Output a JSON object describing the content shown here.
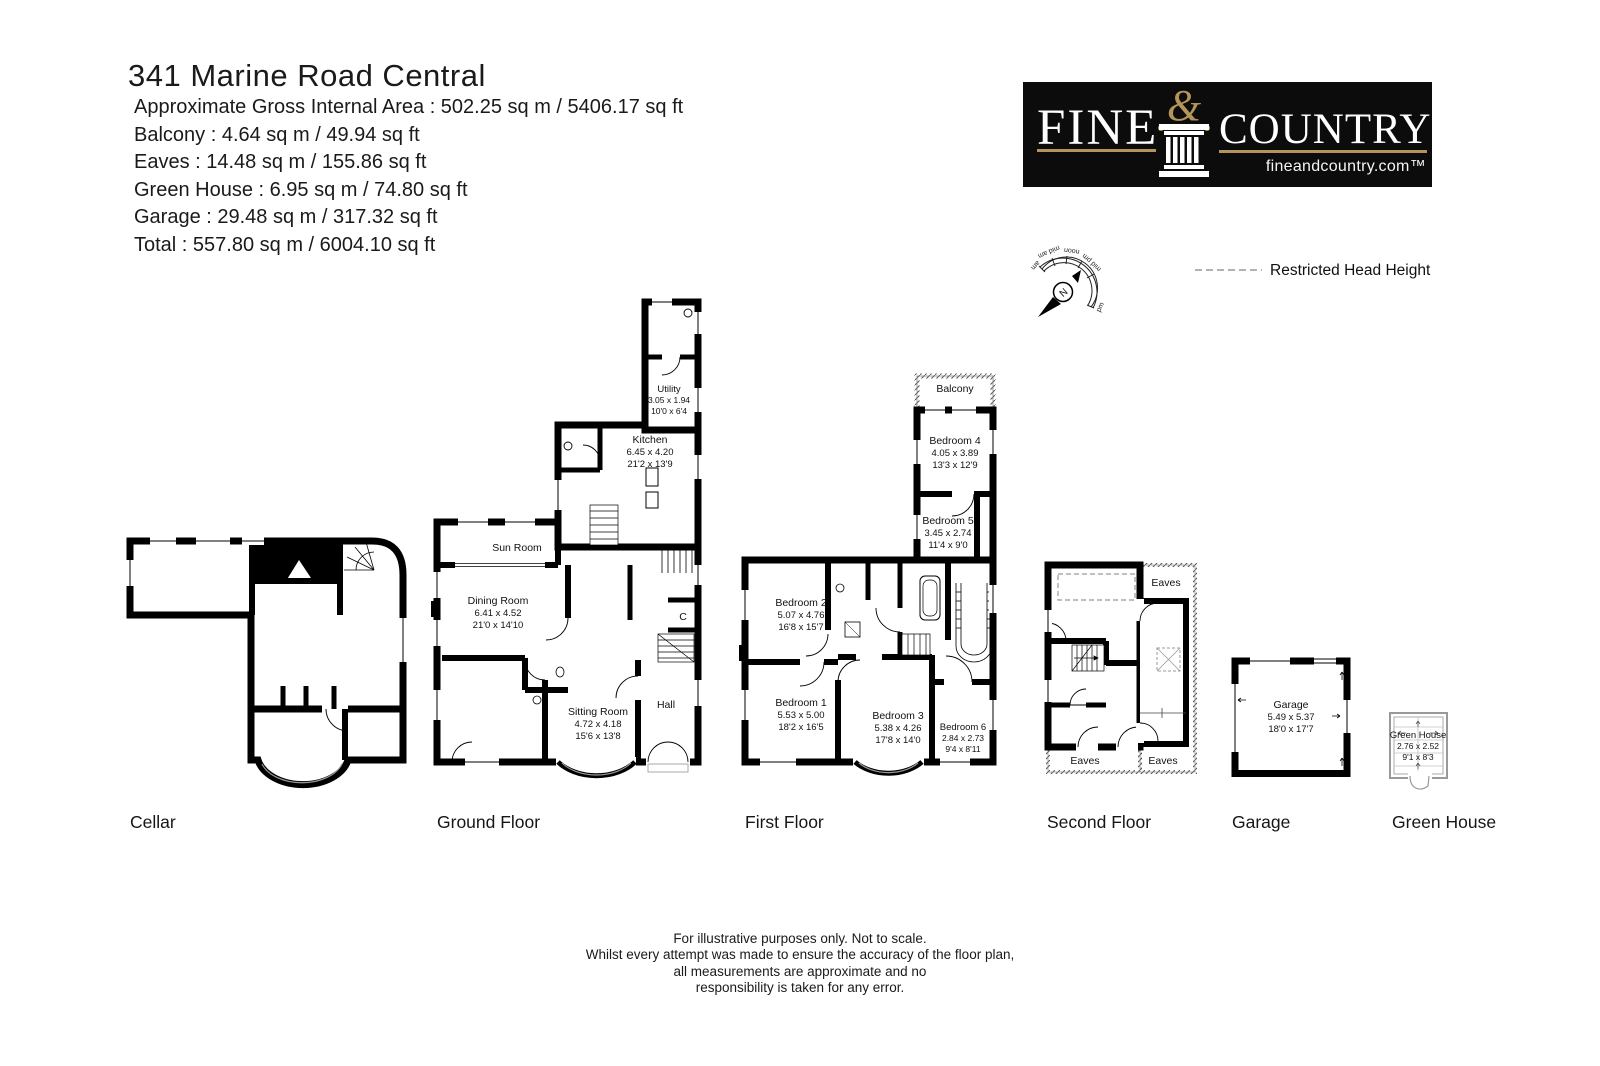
{
  "header": {
    "title": "341 Marine Road Central",
    "lines": [
      "Approximate Gross Internal Area : 502.25 sq m / 5406.17 sq ft",
      "Balcony : 4.64 sq m / 49.94 sq ft",
      "Eaves : 14.48 sq m / 155.86 sq ft",
      "Green House : 6.95 sq m / 74.80 sq ft",
      "Garage : 29.48 sq m / 317.32 sq ft",
      "Total : 557.80 sq m / 6004.10 sq ft"
    ]
  },
  "logo": {
    "fine": "FINE",
    "ampersand": "&",
    "country": "COUNTRY",
    "website": "fineandcountry.com™",
    "bg_color": "#0c0c0c",
    "gold_color": "#b3945a"
  },
  "compass": {
    "am": "am",
    "mid_am": "mid am",
    "noon": "noon",
    "mid_pm": "mid pm",
    "pm": "pm",
    "n": "N"
  },
  "legend": {
    "restricted": "Restricted Head Height",
    "dash_color": "#999999"
  },
  "plans": {
    "cellar": {
      "label": "Cellar"
    },
    "ground": {
      "label": "Ground Floor",
      "utility_name": "Utility",
      "utility_m": "3.05 x 1.94",
      "utility_i": "10'0 x 6'4",
      "kitchen_name": "Kitchen",
      "kitchen_m": "6.45 x 4.20",
      "kitchen_i": "21'2 x 13'9",
      "sunroom_name": "Sun Room",
      "dining_name": "Dining Room",
      "dining_m": "6.41 x 4.52",
      "dining_i": "21'0 x 14'10",
      "sitting_name": "Sitting Room",
      "sitting_m": "4.72 x 4.18",
      "sitting_i": "15'6 x 13'8",
      "hall_name": "Hall",
      "cupboard_name": "C"
    },
    "first": {
      "label": "First Floor",
      "balcony_name": "Balcony",
      "bedroom4_name": "Bedroom 4",
      "bedroom4_m": "4.05 x 3.89",
      "bedroom4_i": "13'3 x 12'9",
      "bedroom5_name": "Bedroom 5",
      "bedroom5_m": "3.45 x 2.74",
      "bedroom5_i": "11'4 x 9'0",
      "bedroom2_name": "Bedroom 2",
      "bedroom2_m": "5.07 x 4.76",
      "bedroom2_i": "16'8 x 15'7",
      "bedroom1_name": "Bedroom 1",
      "bedroom1_m": "5.53 x 5.00",
      "bedroom1_i": "18'2 x 16'5",
      "bedroom3_name": "Bedroom 3",
      "bedroom3_m": "5.38 x 4.26",
      "bedroom3_i": "17'8 x 14'0",
      "bedroom6_name": "Bedroom 6",
      "bedroom6_m": "2.84 x 2.73",
      "bedroom6_i": "9'4 x 8'11"
    },
    "second": {
      "label": "Second Floor",
      "eaves": "Eaves"
    },
    "garage": {
      "label": "Garage",
      "name": "Garage",
      "m": "5.49 x 5.37",
      "i": "18'0 x 17'7"
    },
    "greenhouse": {
      "label": "Green House",
      "name": "Green House",
      "m": "2.76 x 2.52",
      "i": "9'1 x 8'3"
    }
  },
  "footer": {
    "lines": [
      "For illustrative purposes only. Not to scale.",
      "Whilst every attempt was made to ensure the accuracy of the floor plan,",
      "all measurements are approximate and no",
      "responsibility is taken for any error."
    ]
  }
}
